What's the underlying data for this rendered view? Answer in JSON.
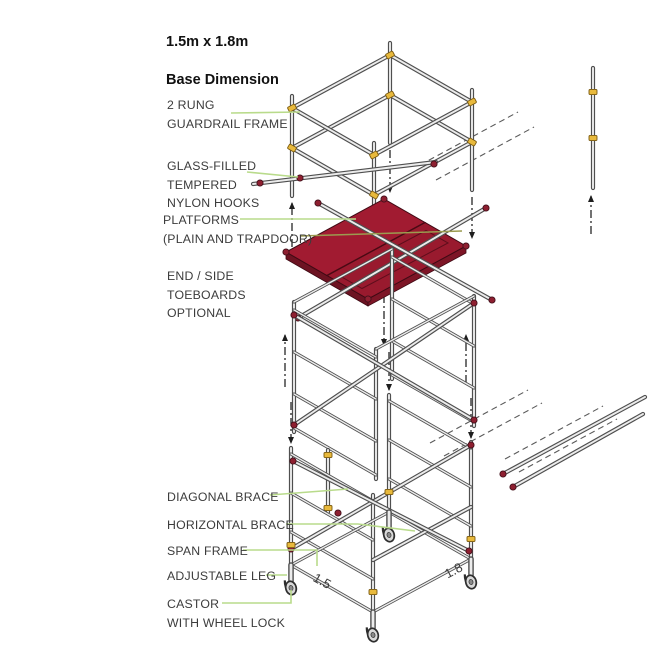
{
  "title": {
    "line1": "1.5m x 1.8m",
    "line2": "Base Dimension"
  },
  "callouts": [
    {
      "id": "two-rung-guardrail-frame",
      "text": "2 RUNG\nGUARDRAIL FRAME"
    },
    {
      "id": "glass-filled-tempered-nylon-hooks",
      "text": "GLASS-FILLED\nTEMPERED\nNYLON HOOKS"
    },
    {
      "id": "platforms",
      "text": "PLATFORMS\n(PLAIN AND TRAPDOOR)"
    },
    {
      "id": "end-side-toeboards",
      "text": "END / SIDE\nTOEBOARDS\nOPTIONAL"
    },
    {
      "id": "diagonal-brace",
      "text": "DIAGONAL BRACE"
    },
    {
      "id": "horizontal-brace",
      "text": "HORIZONTAL BRACE"
    },
    {
      "id": "span-frame",
      "text": "SPAN FRAME"
    },
    {
      "id": "adjustable-leg",
      "text": "ADJUSTABLE LEG"
    },
    {
      "id": "castor",
      "text": "CASTOR\nWITH WHEEL LOCK"
    }
  ],
  "dimensions": {
    "base_width": "1.5",
    "base_depth": "1.8"
  },
  "colors": {
    "platform_red": "#a11b31",
    "hook_yellow": "#e8b93c",
    "clamp_red": "#8e1f30",
    "leader_green": "#b9db8b",
    "leader_olive": "#9b9b4f",
    "tube_outline": "#4f4f4f",
    "tube_highlight": "#ececec",
    "label_text": "#3c3c3c"
  }
}
